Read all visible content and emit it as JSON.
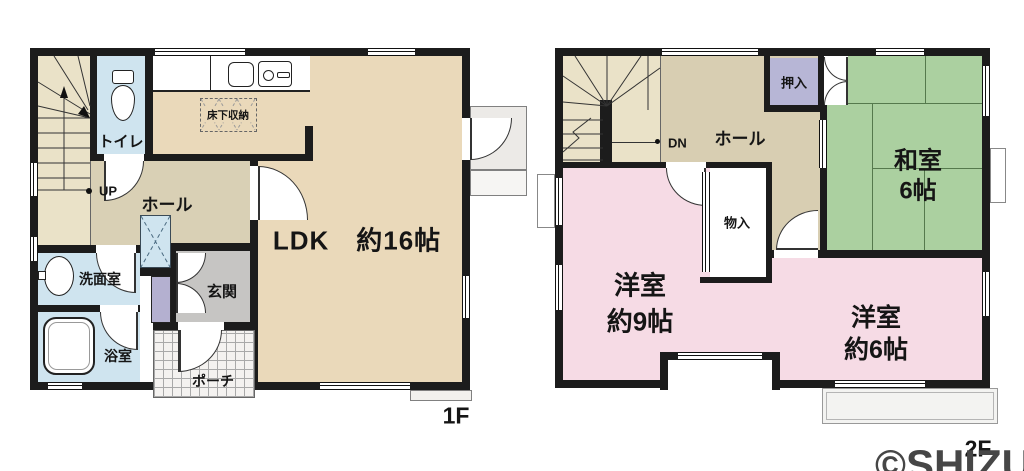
{
  "title": "floor-plan",
  "floor1": {
    "floor_label": "1F",
    "rooms": {
      "ldk": "LDK　約16帖",
      "hall": "ホール",
      "toilet": "トイレ",
      "washroom": "洗面室",
      "bathroom": "浴室",
      "entrance": "玄関",
      "porch": "ポーチ",
      "underfloor_storage": "床下収納"
    },
    "stair_direction": "UP"
  },
  "floor2": {
    "floor_label": "2F",
    "rooms": {
      "hall": "ホール",
      "closet_oshiire": "押入",
      "japanese_room_name": "和室",
      "japanese_room_size": "6帖",
      "western_room9_name": "洋室",
      "western_room9_size": "約9帖",
      "western_room6_name": "洋室",
      "western_room6_size": "約6帖",
      "storage_monoire": "物入"
    },
    "stair_direction": "DN"
  },
  "watermark": "©SHIZUNAVI",
  "icons": {
    "toilet_icon": "css-shape",
    "kitchen_sink_icon": "css-shape",
    "washbasin_icon": "css-shape",
    "bathtub_icon": "css-shape"
  },
  "colors": {
    "wall": "#1c1c1c",
    "ldk_floor": "#ead9ba",
    "hall_floor": "#d9d0b5",
    "stairs_floor": "#eae2c8",
    "wet_room": "#cfe4ef",
    "entrance_floor": "#c6c5c3",
    "shoe_cabinet": "#b4b0d0",
    "oshiire_closet": "#b7b6d6",
    "tatami_green": "#abd0a0",
    "western_room_pink": "#f6dbe5",
    "balcony": "#f3f3f1",
    "watermark_gray": "#464646"
  }
}
